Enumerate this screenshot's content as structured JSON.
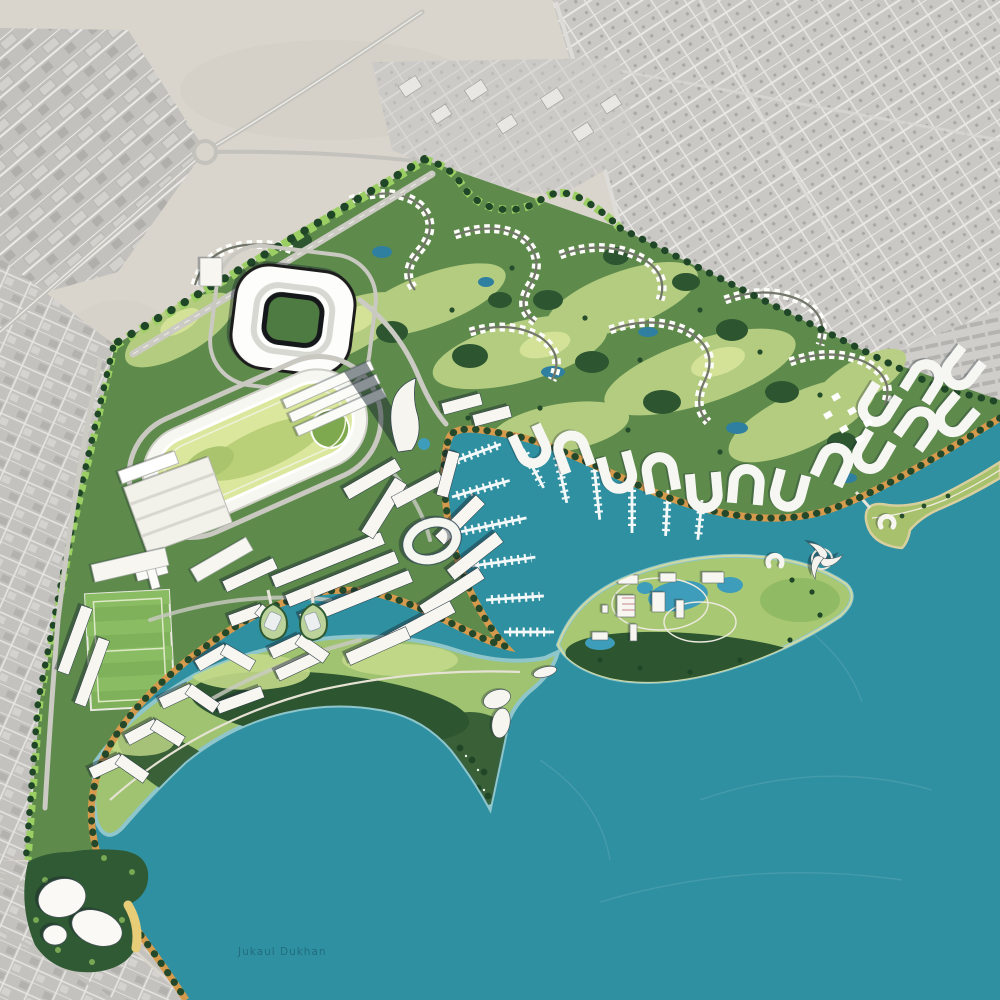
{
  "meta": {
    "type": "master-plan-aerial-map",
    "description": "Colored coastal resort, marina and golf masterplan rendered over a desaturated satellite photo of desert town context"
  },
  "labels": {
    "water_name": "Jukaul Dukhan"
  },
  "colors": {
    "desert": "#d9d5cc",
    "city_gray": "#c8c7c3",
    "site_green": "#5e8b4c",
    "fairway_green": "#b9d083",
    "infield_lime": "#dce79e",
    "tree_dark": "#24482a",
    "water_teal": "#2f90a1",
    "lagoon_blue": "#3e9dba",
    "promenade_tan": "#d59a4c",
    "building_white": "#f7f6f1",
    "beach_sand": "#e7cd78"
  },
  "features": [
    {
      "id": "existing-city-context",
      "label": "existing city (grayscale satellite)"
    },
    {
      "id": "desert",
      "label": "desert ground"
    },
    {
      "id": "stadium",
      "label": "stadium"
    },
    {
      "id": "racetrack",
      "label": "equestrian racetrack"
    },
    {
      "id": "golf-course",
      "label": "golf course with villa rows"
    },
    {
      "id": "central-district",
      "label": "central waterfront district"
    },
    {
      "id": "marina",
      "label": "marina piers and boats"
    },
    {
      "id": "island-resort",
      "label": "island resort with lagoons"
    },
    {
      "id": "golf-peninsula",
      "label": "southern golf peninsula"
    },
    {
      "id": "beach-hotel",
      "label": "beach hotel"
    },
    {
      "id": "promenade",
      "label": "tree-lined waterfront promenade"
    },
    {
      "id": "sand-spit",
      "label": "curved sand spit"
    },
    {
      "id": "sea",
      "label": "sea / bay water"
    }
  ]
}
